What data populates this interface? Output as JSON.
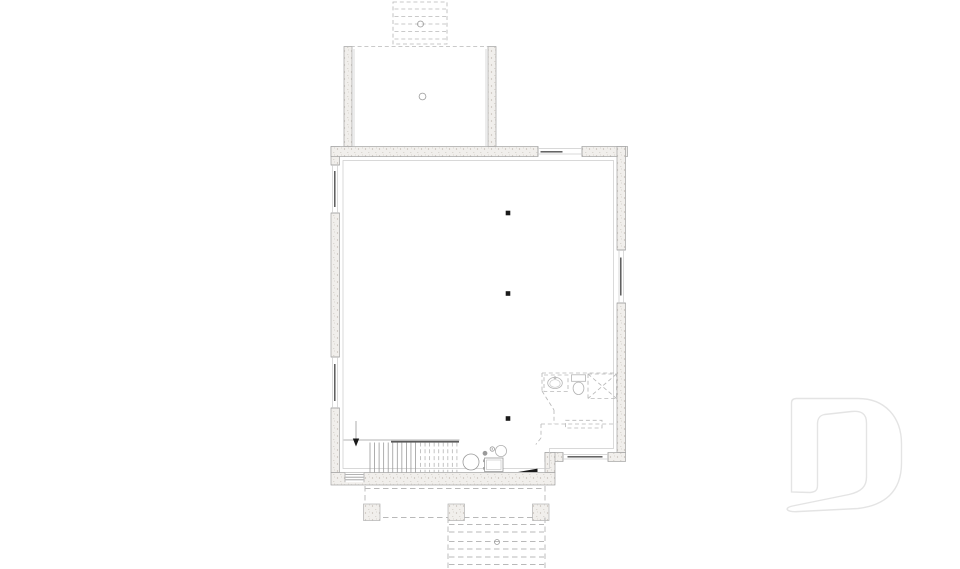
{
  "document": {
    "kind": "architectural-floor-plan",
    "view": "foundation-basement-plan",
    "has_text_labels": false
  },
  "colors": {
    "paper": "#ffffff",
    "wall-fill": "#f1efec",
    "stipple-dot": "#bdb6ad",
    "stipple-dot2": "#cdc8c1",
    "edge": "#a3a3a3",
    "line": "#9a9a9a",
    "faint": "#cbcbcb",
    "light": "#b3b3b3",
    "dash": "#b9b9b9",
    "dark": "#4f4f4f",
    "black": "#1a1a1a",
    "watermark": "#e4e4e4"
  },
  "plan": {
    "columns": [
      {
        "x": 508,
        "y": 213
      },
      {
        "x": 508,
        "y": 293.5
      },
      {
        "x": 508,
        "y": 418.5
      }
    ],
    "column_size": 4.6,
    "stair": {
      "direction": "down",
      "solid_treads": {
        "count": 11,
        "x0": 370,
        "dx": 4.55,
        "y1": 442.5,
        "y2": 472.5
      },
      "dashed_treads": {
        "count": 9,
        "x0": 420.5,
        "dx": 4.55,
        "y1": 442.5,
        "y2": 472.5
      }
    },
    "stoop_treads": {
      "ys": [
        9,
        16.5,
        24,
        31.5,
        39
      ],
      "x1": 394.5,
      "x2": 446
    },
    "deck": {
      "piers": {
        "xs": [
          363.5,
          448,
          532.5
        ],
        "y": 504,
        "size": 16.5
      },
      "step_treads": {
        "ys": [
          524.5,
          532,
          541.5,
          549,
          557,
          564.5
        ],
        "x1": 449,
        "x2": 544
      }
    },
    "fixtures": [
      "water-heater",
      "furnace",
      "floor-drain",
      "sump",
      "vanity-sink",
      "toilet",
      "shower"
    ],
    "watermark": "builder-logo-D"
  }
}
